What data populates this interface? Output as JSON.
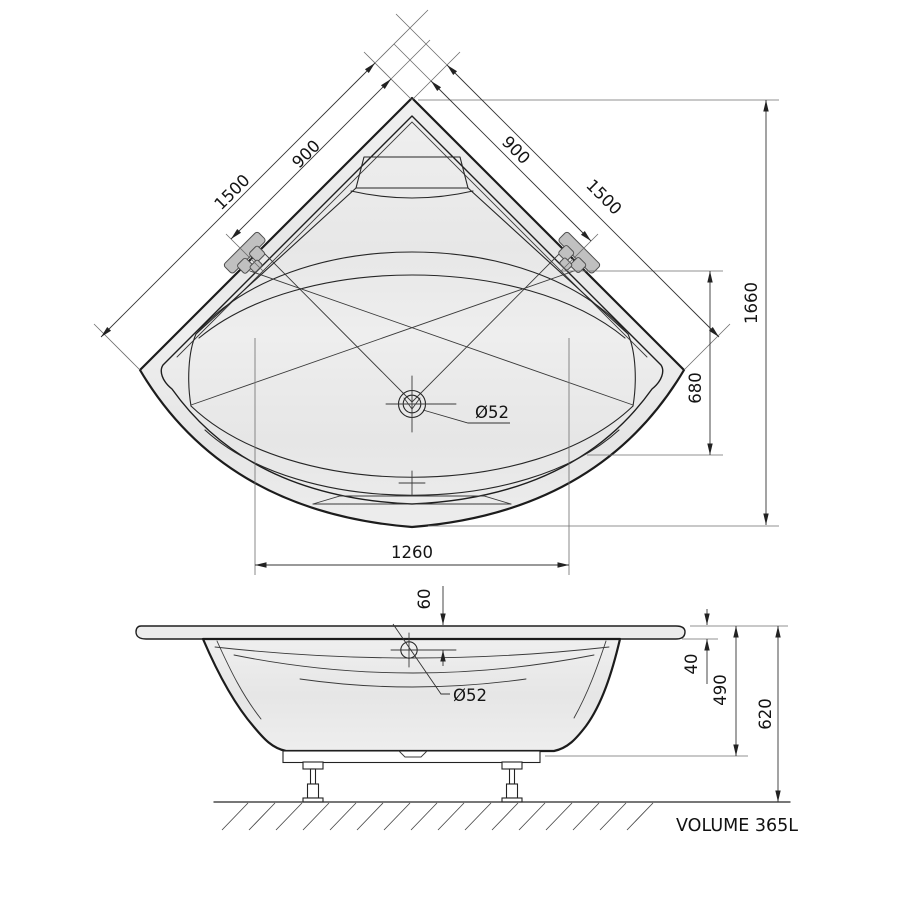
{
  "drawing": {
    "title": "corner-bathtub-technical-drawing",
    "top_view": {
      "dim_edge_left": "1500",
      "dim_faucet_left": "900",
      "dim_faucet_right": "900",
      "dim_edge_right": "1500",
      "dim_diagonal_depth": "1660",
      "dim_inner_offset": "680",
      "dim_front_width": "1260",
      "drain_diameter": "Ø52"
    },
    "front_view": {
      "dim_drain_to_rim": "60",
      "drain_diameter": "Ø52",
      "dim_rim_thickness": "40",
      "dim_shell_height": "490",
      "dim_total_height": "620"
    },
    "footer": {
      "volume_label": "VOLUME 365L"
    },
    "colors": {
      "background": "#ffffff",
      "main_line": "#1c1c1c",
      "dimension_line": "#333333",
      "tub_fill_light": "#f1f1f1",
      "tub_fill_dark": "#e5e5e5",
      "faucet_fill": "#c0c0c0"
    }
  }
}
